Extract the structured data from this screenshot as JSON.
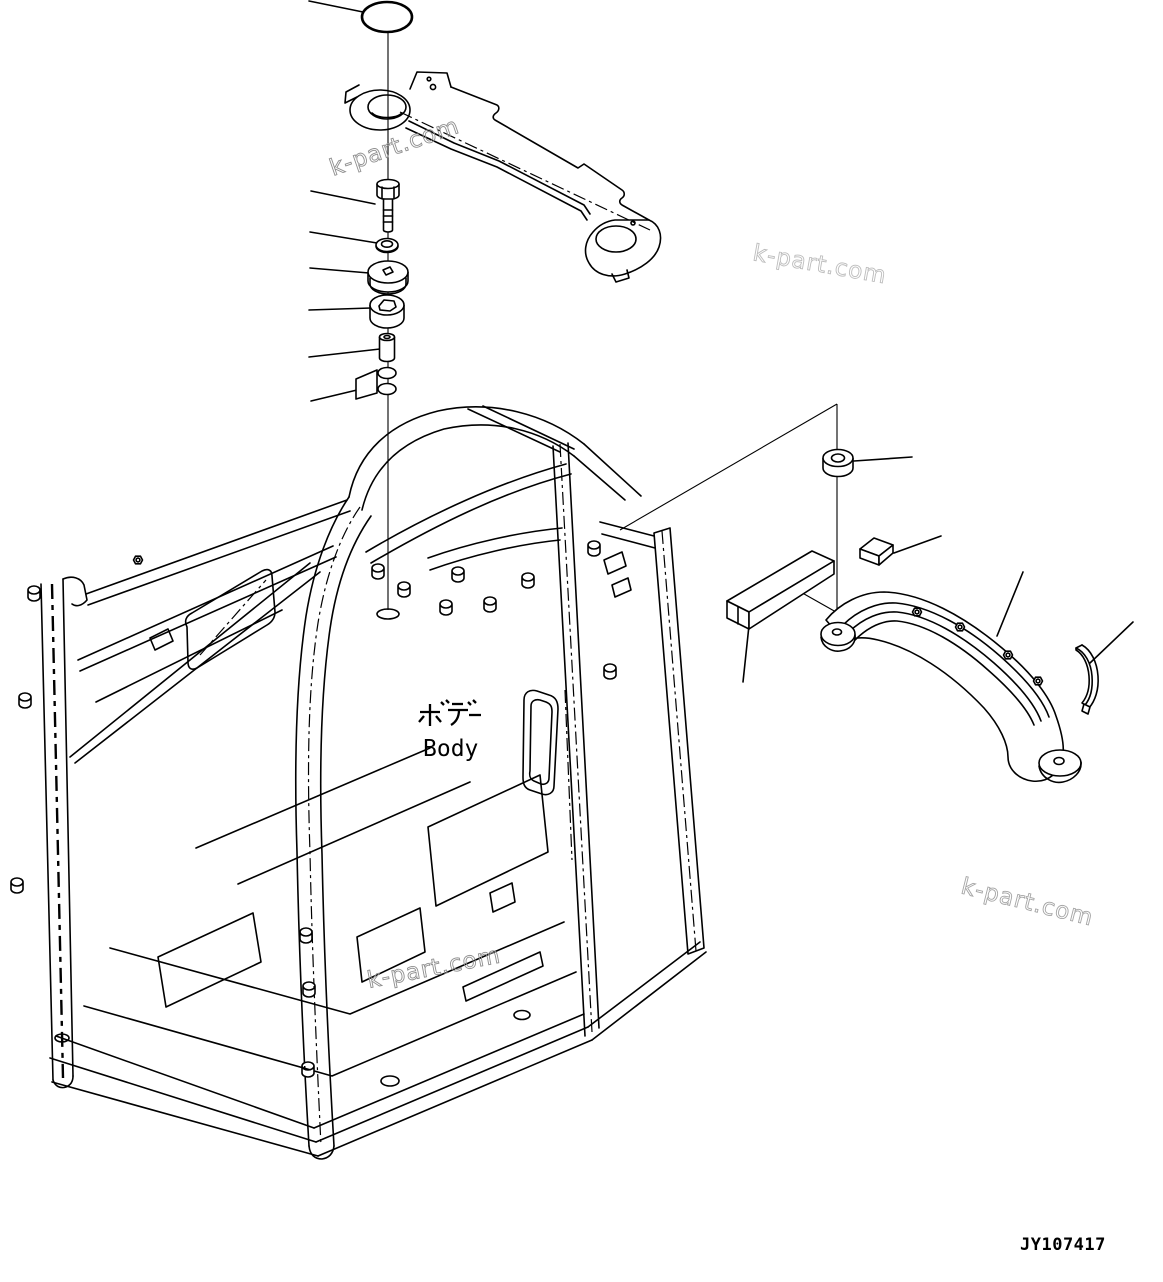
{
  "colors": {
    "background": "#ffffff",
    "line": "#000000",
    "watermark_dark": "#8f8f8f",
    "watermark_light": "#b5b5b5",
    "watermark_mid": "#a5a5a5"
  },
  "watermarks": [
    {
      "text": "k-part.com"
    },
    {
      "text": "k-part.com"
    },
    {
      "text": "k-part.com"
    },
    {
      "text": "k-part.com"
    }
  ],
  "labels": {
    "body_jp": "ボデー",
    "body_en": "Body"
  },
  "part_number": "JY107417"
}
